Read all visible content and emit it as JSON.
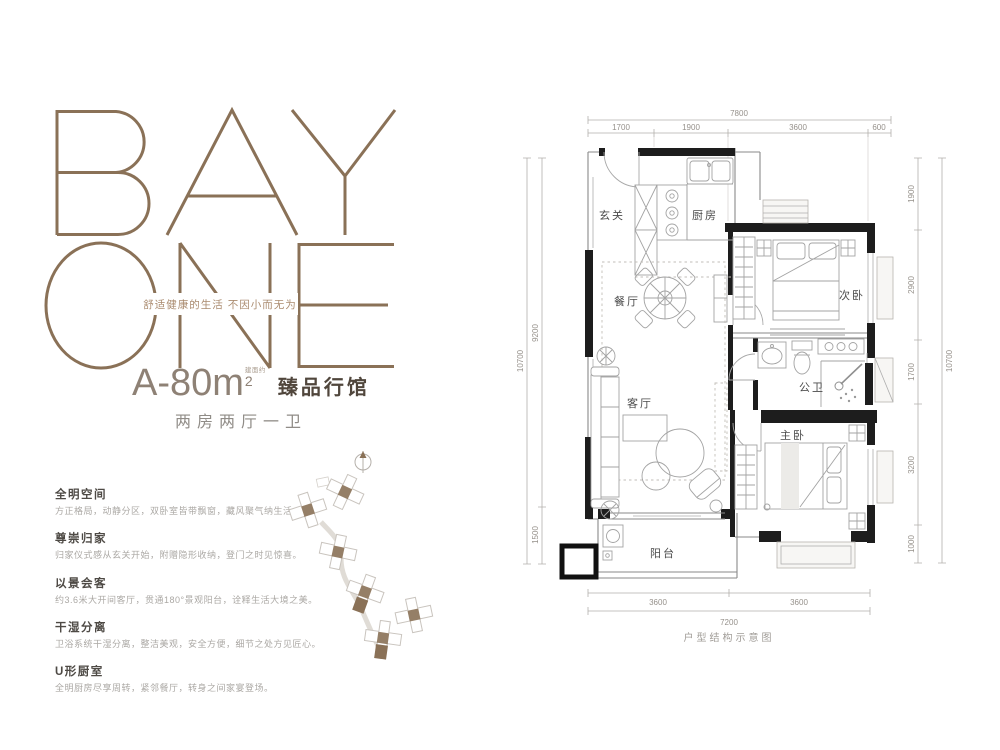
{
  "brand": {
    "logo_line1": "BAY",
    "logo_line2": "ONE",
    "tagline": "舒适健康的生活 不因小而无为",
    "brand_brown": "#8a7157"
  },
  "unit": {
    "model": "A-80m",
    "area_superscript": "2",
    "area_note": "建面约",
    "series_title": "臻品行馆",
    "layout_desc": "两房两厅一卫"
  },
  "features": [
    {
      "title": "全明空间",
      "desc": "方正格局，动静分区，双卧室皆带飘窗，藏风聚气纳生活。"
    },
    {
      "title": "尊崇归家",
      "desc": "归家仪式感从玄关开始，附赠隐形收纳，登门之时见惊喜。"
    },
    {
      "title": "以景会客",
      "desc": "约3.6米大开间客厅，贯通180°景观阳台，诠释生活大境之美。"
    },
    {
      "title": "干湿分离",
      "desc": "卫浴系统干湿分离，整洁美观，安全方便，细节之处方见匠心。"
    },
    {
      "title": "U形厨室",
      "desc": "全明厨房尽享周转，紧邻餐厅，转身之间家宴登场。"
    }
  ],
  "floorplan": {
    "caption": "户型结构示意图",
    "rooms": {
      "entry": "玄关",
      "kitchen": "厨房",
      "dining": "餐厅",
      "living": "客厅",
      "second_bedroom": "次卧",
      "bathroom": "公卫",
      "master_bedroom": "主卧",
      "balcony": "阳台"
    },
    "dimensions": {
      "top_total": "7800",
      "top_segments": [
        "1700",
        "1900",
        "3600",
        "600"
      ],
      "left_total": "10700",
      "left_segments": [
        "9200",
        "1500"
      ],
      "right_total": "10700",
      "right_segments": [
        "1900",
        "2900",
        "1700",
        "3200",
        "1000"
      ],
      "bottom_total": "7200",
      "bottom_segments": [
        "3600",
        "3600"
      ]
    }
  },
  "colors": {
    "brand_brown": "#8a7157",
    "tagline_brown": "#ab8c70",
    "series_dark": "#50463c",
    "text_gray": "#908c87",
    "wall_black": "#1d1d1d",
    "dim_gray": "#96918b"
  }
}
